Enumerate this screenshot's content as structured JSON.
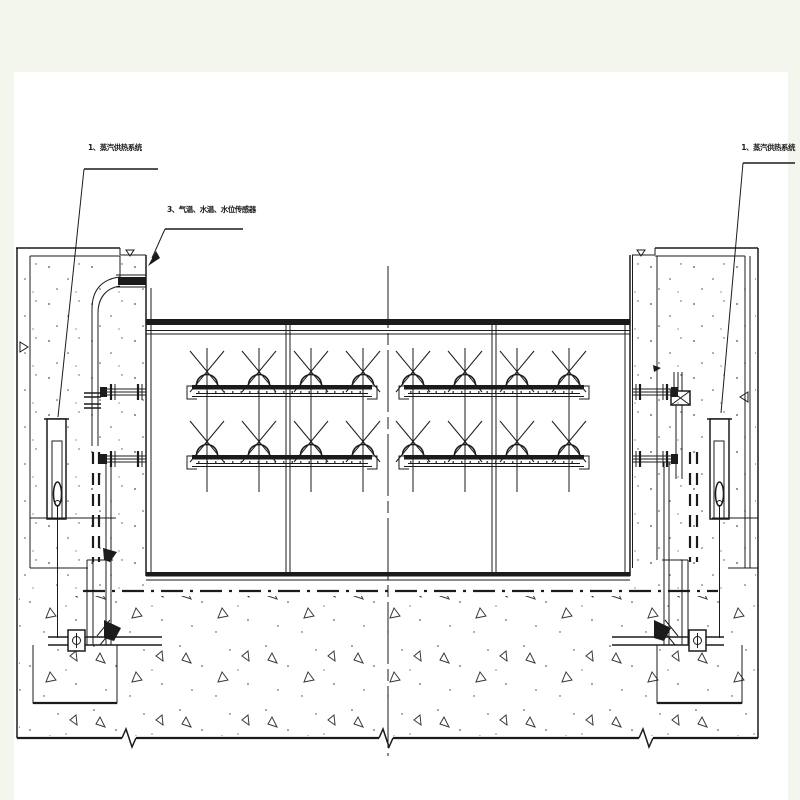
{
  "drawing": {
    "kind": "engineering-section-drawing",
    "colors": {
      "ink": "#1b1b1b",
      "paper": "#ffffff",
      "margin": "#f3f6ec"
    }
  },
  "labels": {
    "steam_left": "1、蒸汽供热系统",
    "sensors": "3、气温、水温、水位传感器",
    "steam_right": "1、蒸汽供热系统"
  }
}
